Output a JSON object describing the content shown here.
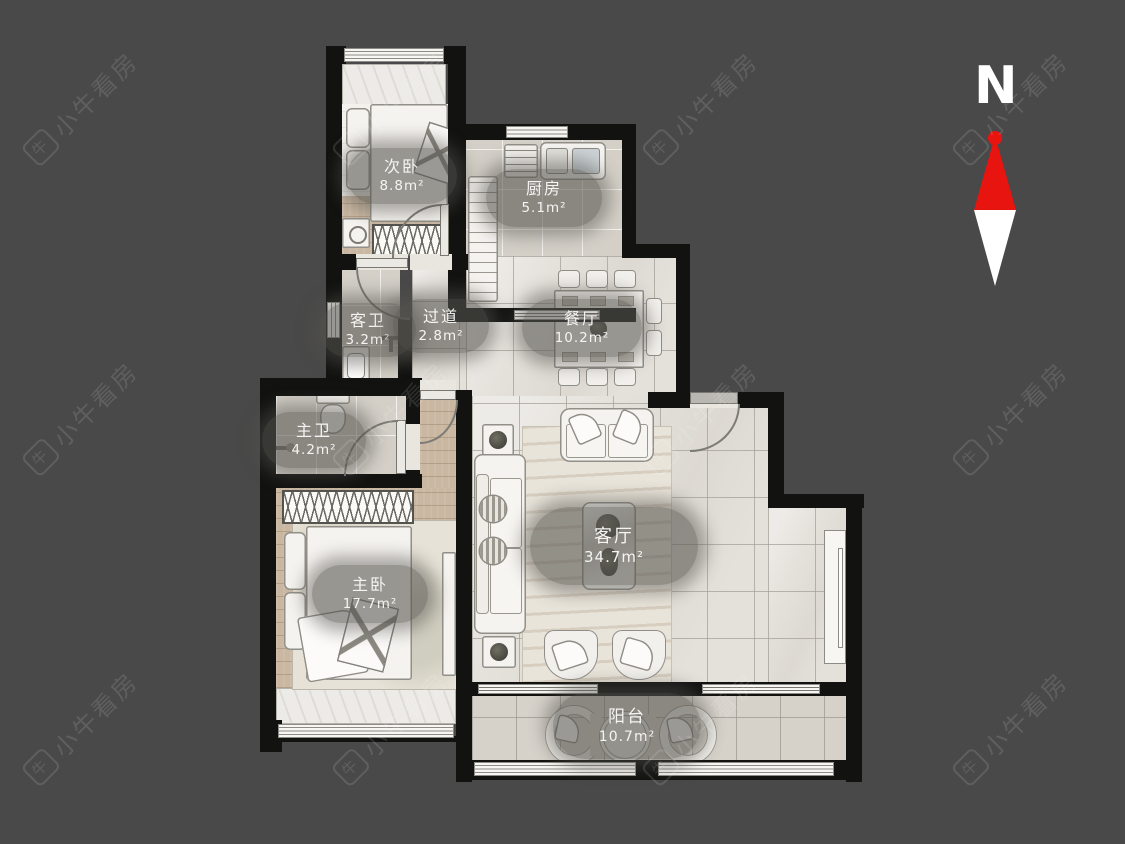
{
  "compass": {
    "label": "N"
  },
  "watermark": {
    "text": "小牛看房",
    "icon": "niu-logo"
  },
  "colors": {
    "background": "#494949",
    "wall": "#121311",
    "north_red": "#e8140f",
    "label_bubble": "rgba(84,82,78,0.58)"
  },
  "rooms": {
    "secondary_bedroom": {
      "name": "次卧",
      "area": "8.8m²"
    },
    "kitchen": {
      "name": "厨房",
      "area": "5.1m²"
    },
    "guest_bath": {
      "name": "客卫",
      "area": "3.2m²"
    },
    "hallway": {
      "name": "过道",
      "area": "2.8m²"
    },
    "dining": {
      "name": "餐厅",
      "area": "10.2m²"
    },
    "master_bath": {
      "name": "主卫",
      "area": "4.2m²"
    },
    "master_bedroom": {
      "name": "主卧",
      "area": "17.7m²"
    },
    "living": {
      "name": "客厅",
      "area": "34.7m²"
    },
    "balcony": {
      "name": "阳台",
      "area": "10.7m²"
    }
  }
}
